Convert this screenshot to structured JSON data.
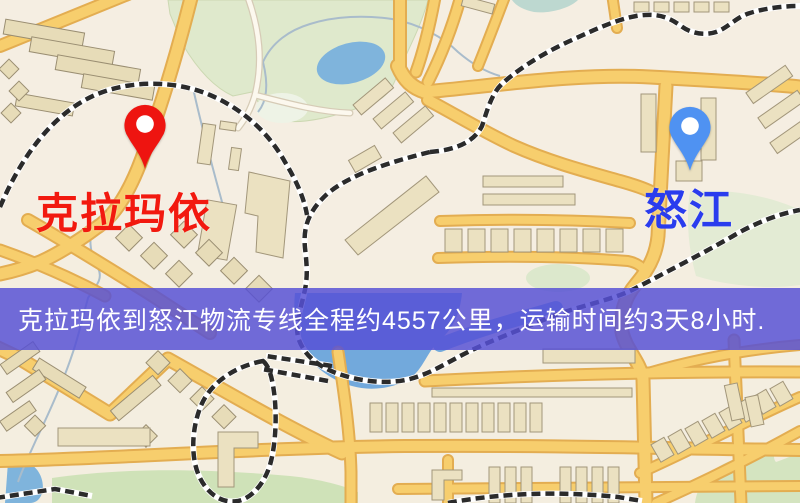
{
  "banner": {
    "text": "克拉玛依到怒江物流专线全程约4557公里，运输时间约3天8小时.",
    "background": "#5650d5",
    "text_color": "#ffffff"
  },
  "markers": {
    "origin": {
      "label": "克拉玛依",
      "label_color": "#f2190f",
      "pin_color": "#ee1410"
    },
    "destination": {
      "label": "怒江",
      "label_color": "#2a3cee",
      "pin_color": "#4f92f2"
    }
  },
  "map": {
    "background": "#f4eee0",
    "road_color": "#f7ce6d",
    "park_color": "#dfe9cc",
    "water_color": "#72a9dc",
    "railway_color": "#2b2b2b"
  }
}
